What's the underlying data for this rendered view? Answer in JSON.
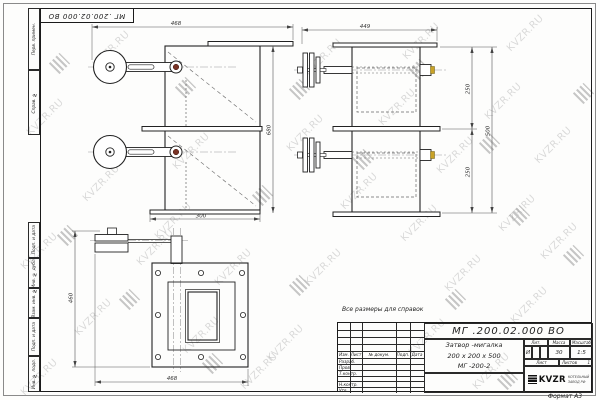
{
  "sheet": {
    "format_label": "Формат А3",
    "note": "Все размеры для справок",
    "top_designation": "МГ .200.02.000 ВО"
  },
  "watermark": {
    "text": "KVZR.RU"
  },
  "margin_labels": [
    "Перв. примен.",
    "Справ. №",
    "Подп. и дата",
    "Инв. № дубл.",
    "Взам. инв. №",
    "Подп. и дата",
    "Инв. № подл."
  ],
  "title_block": {
    "designation": "МГ .200.02.000 ВО",
    "name_line1": "Затвор -мигалка",
    "name_line2": "200 х 200 х 500",
    "name_line3": "МГ -200-2",
    "col_izm": "Изм.",
    "col_list": "Лист",
    "col_doc": "№ докум.",
    "col_podp": "Подп.",
    "col_data": "Дата",
    "row_razrab": "Разраб.",
    "row_prov": "Пров.",
    "row_tkontr": "Т.контр.",
    "row_nkontr": "Н.контр.",
    "row_utv": "Утв.",
    "lit_header": "Лит.",
    "lit_value": "И",
    "mass_header": "Масса",
    "mass_value": "30",
    "scale_header": "Масштаб",
    "scale_value": "1:5",
    "sheet_header": "Лист",
    "sheets_header": "Листов",
    "sheets_value": "1",
    "company_logo": "KVZR",
    "company_line1": "КОТЕЛЬНЫЙ",
    "company_line2": "ЗАВОД РФ"
  },
  "dimensions": {
    "front_width_top": "468",
    "front_height": "680",
    "front_width_bottom": "300",
    "side_width_top": "449",
    "side_segment_top": "250",
    "side_segment_bottom": "250",
    "side_height_total": "500",
    "plan_height_left": "460",
    "plan_width_bottom": "468"
  },
  "colors": {
    "line": "#222222",
    "watermark": "#bdbdbd",
    "pin_accent": "#c9a227",
    "pivot_accent": "#7a3426"
  }
}
